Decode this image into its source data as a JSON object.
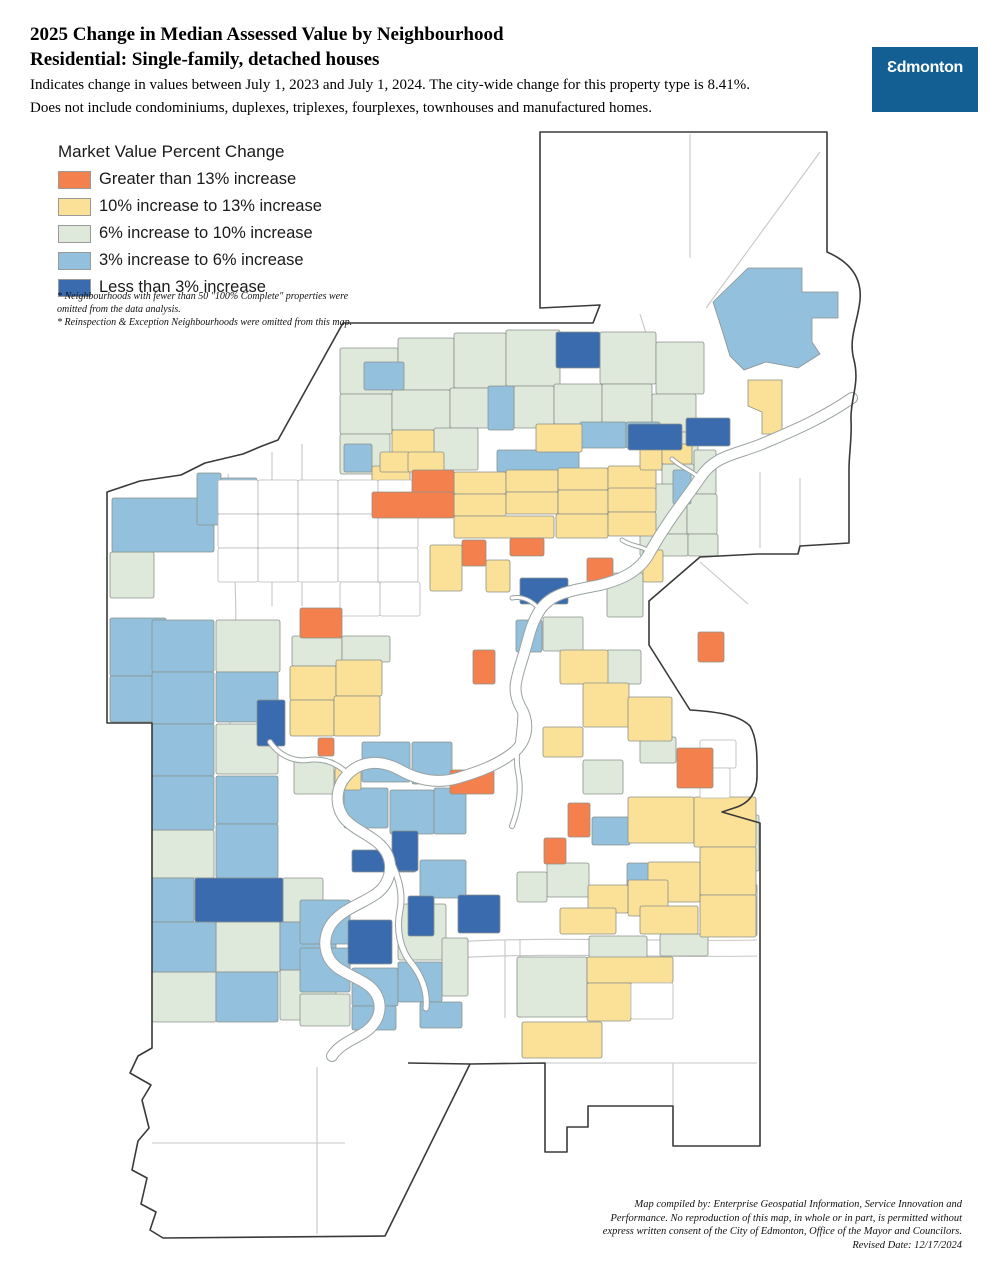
{
  "header": {
    "title_line1": "2025 Change in Median Assessed Value by Neighbourhood",
    "title_line2": "Residential: Single-family, detached houses",
    "desc_line1": "Indicates change in values between July 1, 2023 and July 1, 2024. The city-wide change for this property type is 8.41%.",
    "desc_line2": "Does not include condominiums, duplexes, triplexes, fourplexes, townhouses and manufactured homes.",
    "citywide_change": "8.41%"
  },
  "logo": {
    "text": "Ɛdmonton",
    "bg_color": "#135F93"
  },
  "legend": {
    "title": "Market Value Percent Change",
    "items": [
      {
        "label": "Greater than 13% increase",
        "color": "#F4804E",
        "key": "o"
      },
      {
        "label": "10% increase to 13% increase",
        "color": "#FBE098",
        "key": "y"
      },
      {
        "label": "6% increase to 10% increase",
        "color": "#DEE8DB",
        "key": "g"
      },
      {
        "label": "3% increase to 6% increase",
        "color": "#92C0DD",
        "key": "b"
      },
      {
        "label": "Less than 3% increase",
        "color": "#3A6BAE",
        "key": "d"
      }
    ]
  },
  "notes": [
    "* Neighbourhoods with fewer than 50 \"100% Complete\" properties were omitted from the data analysis.",
    "* Reinspection & Exception Neighbourhoods were omitted from this map."
  ],
  "credits": [
    "Map compiled by: Enterprise Geospatial Information, Service Innovation and",
    "Performance. No reproduction of this map, in whole or in part, is permitted without",
    "express written consent of the City of Edmonton, Office of the Mayor and Councilors.",
    "Revised Date: 12/17/2024"
  ],
  "map": {
    "canvas": {
      "w": 990,
      "h": 1280
    },
    "colors": {
      "o": "#F4804E",
      "y": "#FBE098",
      "g": "#DEE8DB",
      "b": "#92C0DD",
      "d": "#3A6BAE",
      "w": "#FFFFFF"
    },
    "boundary": "M 540,132 L 827,132 L 827,252 C 850,262 862,278 860,300 C 858,322 848,338 854,360 C 860,384 850,400 851,420 C 852,440 849,452 849,470 L 849,543 L 800,546 L 798,554 L 758,554 L 700,557 L 649,601 L 649,645 L 690,710 C 722,712 740,716 750,726 C 758,740 757,760 757,776 C 757,794 748,804 734,808 L 722,812 L 760,823 L 760,1146 L 673,1146 L 673,1106 L 588,1106 L 588,1127 L 567,1127 L 567,1152 L 545,1152 L 545,1063 L 470,1064 L 385,1236 L 163,1238 L 150,1230 L 156,1212 L 141,1204 L 147,1178 L 132,1170 L 138,1141 L 149,1128 L 142,1100 L 151,1085 L 130,1073 L 138,1056 L 152,1048 L 152,723 L 107,723 L 107,492 L 140,481 L 181,475 L 205,463 L 243,454 L 262,446 L 278,440 L 343,323 L 593,323 L 600,305 L 540,308 Z",
    "boundary_extra": [
      "M470,1064 L408,1063"
    ],
    "roads": [
      "M317,1067 L317,1234",
      "M152,1143 L345,1143",
      "M545,1063 L757,1063",
      "M673,1063 L673,1106",
      "M505,940 L505,1018",
      "M520,940 L520,1018",
      "M450,942 C560,936 660,942 757,940",
      "M452,958 C560,952 660,958 757,956",
      "M690,134 L690,258",
      "M820,152 L706,308",
      "M640,314 L668,404",
      "M760,472 L760,548",
      "M800,478 L800,546",
      "M700,562 L748,604",
      "M228,474 C236,560 240,650 230,724",
      "M302,444 L302,606",
      "M272,452 L272,606"
    ],
    "river": {
      "main": {
        "d": "M852,398 C820,420 790,432 762,444 C735,455 715,455 700,478 C685,500 668,520 650,552 C640,572 620,580 600,585 C575,590 552,592 540,610 C530,625 528,642 522,660 C516,680 512,690 520,706 C530,722 528,740 514,752 C498,765 478,772 458,778 C438,784 418,780 400,770 C382,760 362,760 348,774 C336,786 334,804 344,818 C356,832 376,836 386,852 C394,866 390,884 376,894 C360,905 340,910 330,926 C322,940 324,958 338,968 C354,979 372,982 378,998 C383,1012 376,1026 362,1034 C350,1041 338,1046 332,1056",
        "w": 10
      },
      "branches": [
        {
          "d": "M386,852 C396,870 404,890 400,910 C396,930 400,950 412,964 C420,974 428,990 426,1008",
          "w": 5
        },
        {
          "d": "M520,706 C522,730 514,750 518,772 C522,790 518,810 512,826",
          "w": 4
        },
        {
          "d": "M348,774 C336,762 322,758 308,760 C292,762 278,754 270,742",
          "w": 4
        },
        {
          "d": "M700,478 C690,470 681,467 672,459",
          "w": 3
        },
        {
          "d": "M650,552 C641,545 632,547 622,540",
          "w": 3
        },
        {
          "d": "M540,610 C532,600 522,596 512,598",
          "w": 3
        }
      ]
    },
    "polys": [
      {
        "pts": "713,302 748,268 802,268 802,292 838,292 838,318 812,318 812,342 820,354 798,368 766,362 744,370 730,356 722,330",
        "c": "b"
      },
      {
        "pts": "748,380 782,380 782,434 762,434 762,412 748,406",
        "c": "y"
      }
    ],
    "regions": [
      [
        340,
        348,
        58,
        46,
        "g"
      ],
      [
        398,
        338,
        56,
        52,
        "g"
      ],
      [
        454,
        333,
        52,
        55,
        "g"
      ],
      [
        506,
        330,
        54,
        56,
        "g"
      ],
      [
        600,
        332,
        56,
        52,
        "g"
      ],
      [
        656,
        342,
        48,
        52,
        "g"
      ],
      [
        340,
        394,
        52,
        40,
        "g"
      ],
      [
        392,
        390,
        58,
        40,
        "g"
      ],
      [
        450,
        388,
        40,
        40,
        "g"
      ],
      [
        514,
        386,
        40,
        42,
        "g"
      ],
      [
        554,
        384,
        48,
        40,
        "g"
      ],
      [
        602,
        384,
        50,
        40,
        "g"
      ],
      [
        652,
        394,
        44,
        38,
        "g"
      ],
      [
        340,
        434,
        50,
        40,
        "g"
      ],
      [
        434,
        428,
        44,
        42,
        "g"
      ],
      [
        658,
        432,
        40,
        38,
        "g"
      ],
      [
        662,
        464,
        32,
        30,
        "g"
      ],
      [
        694,
        450,
        22,
        44,
        "g"
      ],
      [
        633,
        484,
        54,
        50,
        "g"
      ],
      [
        687,
        494,
        30,
        40,
        "g"
      ],
      [
        640,
        534,
        48,
        22,
        "g"
      ],
      [
        688,
        534,
        30,
        22,
        "g"
      ],
      [
        607,
        573,
        36,
        44,
        "g"
      ],
      [
        607,
        650,
        34,
        34,
        "g"
      ],
      [
        543,
        617,
        40,
        34,
        "g"
      ],
      [
        110,
        552,
        44,
        46,
        "g"
      ],
      [
        216,
        620,
        64,
        52,
        "g"
      ],
      [
        216,
        724,
        62,
        50,
        "g"
      ],
      [
        152,
        830,
        62,
        48,
        "g"
      ],
      [
        283,
        878,
        40,
        44,
        "g"
      ],
      [
        216,
        922,
        64,
        50,
        "g"
      ],
      [
        152,
        972,
        64,
        50,
        "g"
      ],
      [
        280,
        970,
        56,
        50,
        "g"
      ],
      [
        292,
        636,
        50,
        30,
        "g"
      ],
      [
        342,
        636,
        48,
        26,
        "g"
      ],
      [
        294,
        760,
        40,
        34,
        "g"
      ],
      [
        398,
        904,
        48,
        56,
        "g"
      ],
      [
        442,
        938,
        26,
        58,
        "g"
      ],
      [
        300,
        994,
        50,
        32,
        "g"
      ],
      [
        547,
        863,
        42,
        34,
        "g"
      ],
      [
        517,
        872,
        30,
        30,
        "g"
      ],
      [
        589,
        936,
        58,
        22,
        "g"
      ],
      [
        660,
        934,
        48,
        22,
        "g"
      ],
      [
        715,
        815,
        44,
        56,
        "g"
      ],
      [
        738,
        884,
        19,
        52,
        "g"
      ],
      [
        583,
        760,
        40,
        34,
        "g"
      ],
      [
        640,
        737,
        36,
        26,
        "g"
      ],
      [
        517,
        957,
        70,
        60,
        "g"
      ],
      [
        112,
        498,
        102,
        54,
        "b"
      ],
      [
        197,
        473,
        24,
        52,
        "b"
      ],
      [
        221,
        478,
        36,
        44,
        "b"
      ],
      [
        110,
        618,
        56,
        58,
        "b"
      ],
      [
        110,
        676,
        56,
        46,
        "b"
      ],
      [
        364,
        362,
        40,
        28,
        "b"
      ],
      [
        488,
        386,
        26,
        44,
        "b"
      ],
      [
        580,
        422,
        46,
        26,
        "b"
      ],
      [
        626,
        422,
        34,
        26,
        "b"
      ],
      [
        344,
        444,
        28,
        28,
        "b"
      ],
      [
        497,
        450,
        82,
        22,
        "b"
      ],
      [
        673,
        470,
        18,
        34,
        "b"
      ],
      [
        152,
        620,
        62,
        52,
        "b"
      ],
      [
        152,
        672,
        62,
        52,
        "b"
      ],
      [
        216,
        672,
        62,
        50,
        "b"
      ],
      [
        152,
        724,
        62,
        52,
        "b"
      ],
      [
        152,
        776,
        62,
        54,
        "b"
      ],
      [
        216,
        776,
        62,
        48,
        "b"
      ],
      [
        216,
        824,
        62,
        54,
        "b"
      ],
      [
        152,
        878,
        42,
        44,
        "b"
      ],
      [
        152,
        922,
        64,
        50,
        "b"
      ],
      [
        216,
        972,
        62,
        50,
        "b"
      ],
      [
        280,
        922,
        56,
        48,
        "b"
      ],
      [
        362,
        742,
        48,
        40,
        "b"
      ],
      [
        412,
        742,
        40,
        42,
        "b"
      ],
      [
        344,
        788,
        44,
        40,
        "b"
      ],
      [
        390,
        790,
        44,
        44,
        "b"
      ],
      [
        434,
        788,
        32,
        46,
        "b"
      ],
      [
        420,
        860,
        46,
        38,
        "b"
      ],
      [
        300,
        900,
        50,
        44,
        "b"
      ],
      [
        300,
        948,
        50,
        44,
        "b"
      ],
      [
        352,
        968,
        46,
        38,
        "b"
      ],
      [
        398,
        962,
        44,
        40,
        "b"
      ],
      [
        420,
        1002,
        42,
        26,
        "b"
      ],
      [
        352,
        1006,
        44,
        24,
        "b"
      ],
      [
        516,
        620,
        26,
        32,
        "b"
      ],
      [
        592,
        817,
        38,
        28,
        "b"
      ],
      [
        627,
        863,
        22,
        28,
        "b"
      ],
      [
        372,
        466,
        38,
        24,
        "y"
      ],
      [
        454,
        472,
        52,
        22,
        "y"
      ],
      [
        506,
        470,
        52,
        22,
        "y"
      ],
      [
        558,
        468,
        50,
        22,
        "y"
      ],
      [
        608,
        466,
        48,
        24,
        "y"
      ],
      [
        454,
        494,
        52,
        22,
        "y"
      ],
      [
        506,
        492,
        52,
        22,
        "y"
      ],
      [
        558,
        490,
        50,
        24,
        "y"
      ],
      [
        608,
        488,
        48,
        24,
        "y"
      ],
      [
        454,
        516,
        100,
        22,
        "y"
      ],
      [
        556,
        514,
        52,
        24,
        "y"
      ],
      [
        608,
        512,
        48,
        24,
        "y"
      ],
      [
        392,
        430,
        42,
        24,
        "y"
      ],
      [
        536,
        424,
        46,
        28,
        "y"
      ],
      [
        380,
        452,
        30,
        20,
        "y"
      ],
      [
        408,
        452,
        36,
        20,
        "y"
      ],
      [
        640,
        448,
        22,
        22,
        "y"
      ],
      [
        662,
        444,
        30,
        20,
        "y"
      ],
      [
        430,
        545,
        32,
        46,
        "y"
      ],
      [
        486,
        560,
        24,
        32,
        "y"
      ],
      [
        643,
        550,
        20,
        32,
        "y"
      ],
      [
        560,
        650,
        48,
        34,
        "y"
      ],
      [
        583,
        683,
        46,
        44,
        "y"
      ],
      [
        543,
        727,
        40,
        30,
        "y"
      ],
      [
        628,
        697,
        44,
        44,
        "y"
      ],
      [
        290,
        666,
        46,
        34,
        "y"
      ],
      [
        336,
        660,
        46,
        36,
        "y"
      ],
      [
        290,
        700,
        44,
        36,
        "y"
      ],
      [
        334,
        696,
        46,
        40,
        "y"
      ],
      [
        335,
        768,
        26,
        22,
        "y"
      ],
      [
        628,
        797,
        66,
        46,
        "y"
      ],
      [
        694,
        797,
        62,
        50,
        "y"
      ],
      [
        700,
        847,
        56,
        48,
        "y"
      ],
      [
        648,
        862,
        52,
        40,
        "y"
      ],
      [
        628,
        880,
        40,
        36,
        "y"
      ],
      [
        588,
        885,
        40,
        28,
        "y"
      ],
      [
        640,
        906,
        58,
        28,
        "y"
      ],
      [
        700,
        895,
        56,
        42,
        "y"
      ],
      [
        560,
        908,
        56,
        26,
        "y"
      ],
      [
        587,
        957,
        86,
        26,
        "y"
      ],
      [
        587,
        983,
        44,
        38,
        "y"
      ],
      [
        522,
        1022,
        80,
        36,
        "y"
      ],
      [
        218,
        480,
        40,
        34,
        "w"
      ],
      [
        258,
        480,
        40,
        34,
        "w"
      ],
      [
        298,
        480,
        40,
        34,
        "w"
      ],
      [
        338,
        480,
        40,
        34,
        "w"
      ],
      [
        378,
        480,
        40,
        34,
        "w"
      ],
      [
        418,
        478,
        36,
        36,
        "w"
      ],
      [
        218,
        514,
        40,
        34,
        "w"
      ],
      [
        258,
        514,
        40,
        34,
        "w"
      ],
      [
        298,
        514,
        40,
        34,
        "w"
      ],
      [
        338,
        514,
        40,
        34,
        "w"
      ],
      [
        378,
        514,
        40,
        34,
        "w"
      ],
      [
        218,
        548,
        40,
        34,
        "w"
      ],
      [
        258,
        548,
        40,
        34,
        "w"
      ],
      [
        298,
        548,
        40,
        34,
        "w"
      ],
      [
        338,
        548,
        40,
        34,
        "w"
      ],
      [
        378,
        548,
        40,
        34,
        "w"
      ],
      [
        340,
        582,
        40,
        34,
        "w"
      ],
      [
        380,
        582,
        40,
        34,
        "w"
      ],
      [
        700,
        740,
        36,
        28,
        "w"
      ],
      [
        700,
        768,
        30,
        30,
        "w"
      ],
      [
        631,
        983,
        42,
        36,
        "w"
      ],
      [
        556,
        332,
        44,
        36,
        "d"
      ],
      [
        628,
        424,
        54,
        26,
        "d"
      ],
      [
        686,
        418,
        44,
        28,
        "d"
      ],
      [
        520,
        578,
        48,
        26,
        "d"
      ],
      [
        257,
        700,
        28,
        46,
        "d"
      ],
      [
        195,
        878,
        88,
        44,
        "d"
      ],
      [
        352,
        850,
        64,
        22,
        "d"
      ],
      [
        392,
        831,
        26,
        40,
        "d"
      ],
      [
        348,
        920,
        44,
        44,
        "d"
      ],
      [
        408,
        896,
        26,
        40,
        "d"
      ],
      [
        458,
        895,
        42,
        38,
        "d"
      ],
      [
        412,
        470,
        42,
        26,
        "o"
      ],
      [
        372,
        492,
        82,
        26,
        "o"
      ],
      [
        462,
        540,
        24,
        26,
        "o"
      ],
      [
        510,
        538,
        34,
        18,
        "o"
      ],
      [
        587,
        558,
        26,
        26,
        "o"
      ],
      [
        473,
        650,
        22,
        34,
        "o"
      ],
      [
        698,
        632,
        26,
        30,
        "o"
      ],
      [
        300,
        608,
        42,
        30,
        "o"
      ],
      [
        318,
        738,
        16,
        18,
        "o"
      ],
      [
        677,
        748,
        36,
        40,
        "o"
      ],
      [
        450,
        770,
        44,
        24,
        "o"
      ],
      [
        568,
        803,
        22,
        34,
        "o"
      ],
      [
        544,
        838,
        22,
        26,
        "o"
      ]
    ]
  }
}
